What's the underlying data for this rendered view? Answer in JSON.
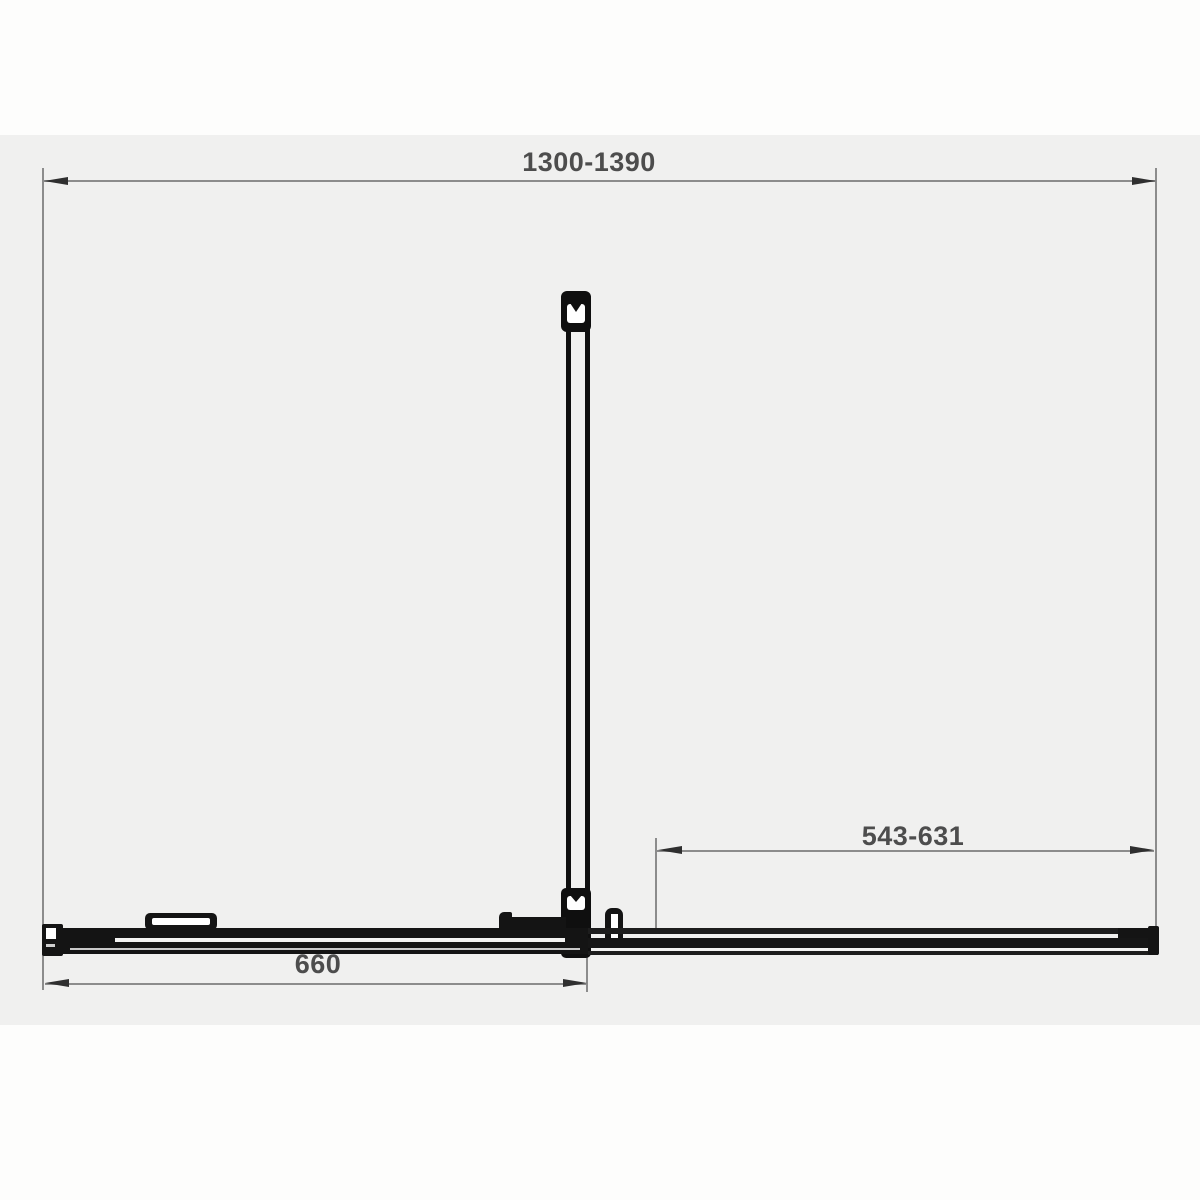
{
  "diagram": {
    "name": "shower-enclosure-plan-view",
    "unit": "mm",
    "dimensions": {
      "overall_width": {
        "label": "1300-1390"
      },
      "door_opening": {
        "label": "543-631"
      },
      "fixed_panel": {
        "label": "660"
      }
    },
    "colors": {
      "page_background": "#fdfdfc",
      "panel_background": "#f0f0ef",
      "dimension_line": "#8c8c8c",
      "arrow": "#2f2f2f",
      "profile": "#101010",
      "label_text": "#4d4d4d"
    }
  }
}
